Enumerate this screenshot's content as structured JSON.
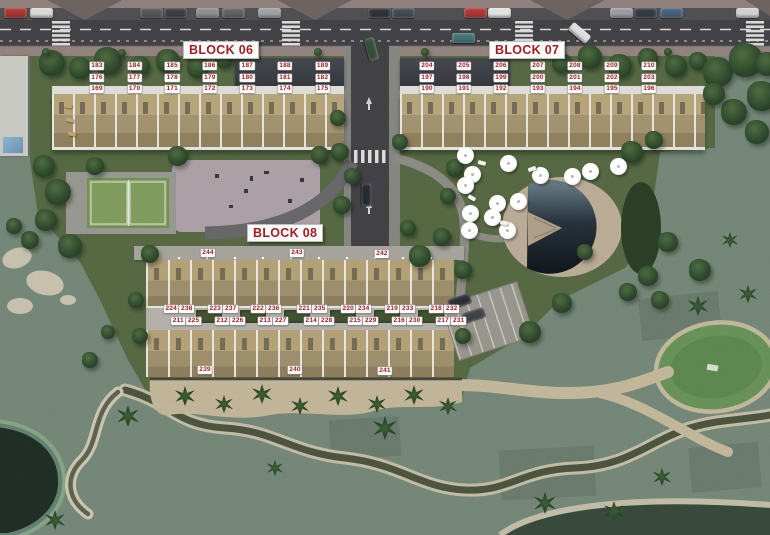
{
  "labels": {
    "blocks": [
      {
        "id": "block-06",
        "label": "BLOCK 06"
      },
      {
        "id": "block-07",
        "label": "BLOCK 07"
      },
      {
        "id": "block-08",
        "label": "BLOCK 08"
      }
    ],
    "block06_rows": [
      [
        "183",
        "184",
        "185",
        "186",
        "187",
        "188",
        "189"
      ],
      [
        "176",
        "177",
        "178",
        "179",
        "180",
        "181",
        "182"
      ],
      [
        "169",
        "170",
        "171",
        "172",
        "173",
        "174",
        "175"
      ]
    ],
    "block07_rows": [
      [
        "204",
        "205",
        "206",
        "207",
        "208",
        "209",
        "210"
      ],
      [
        "197",
        "198",
        "199",
        "200",
        "201",
        "202",
        "203"
      ],
      [
        "190",
        "191",
        "192",
        "193",
        "194",
        "195",
        "196"
      ]
    ],
    "block08": {
      "top_row": [
        "244",
        "243",
        "242"
      ],
      "bottom_row": [
        "239",
        "240",
        "241"
      ],
      "upper_pairs": [
        [
          "224",
          "238"
        ],
        [
          "223",
          "237"
        ],
        [
          "222",
          "236"
        ],
        [
          "221",
          "235"
        ],
        [
          "220",
          "234"
        ],
        [
          "219",
          "233"
        ],
        [
          "218",
          "232"
        ]
      ],
      "lower_pairs": [
        [
          "211",
          "225"
        ],
        [
          "212",
          "226"
        ],
        [
          "213",
          "227"
        ],
        [
          "214",
          "228"
        ],
        [
          "215",
          "229"
        ],
        [
          "216",
          "230"
        ],
        [
          "217",
          "231"
        ]
      ]
    },
    "colors": {
      "label_text": "#9e1b20",
      "label_bg": "#ffffff"
    }
  }
}
